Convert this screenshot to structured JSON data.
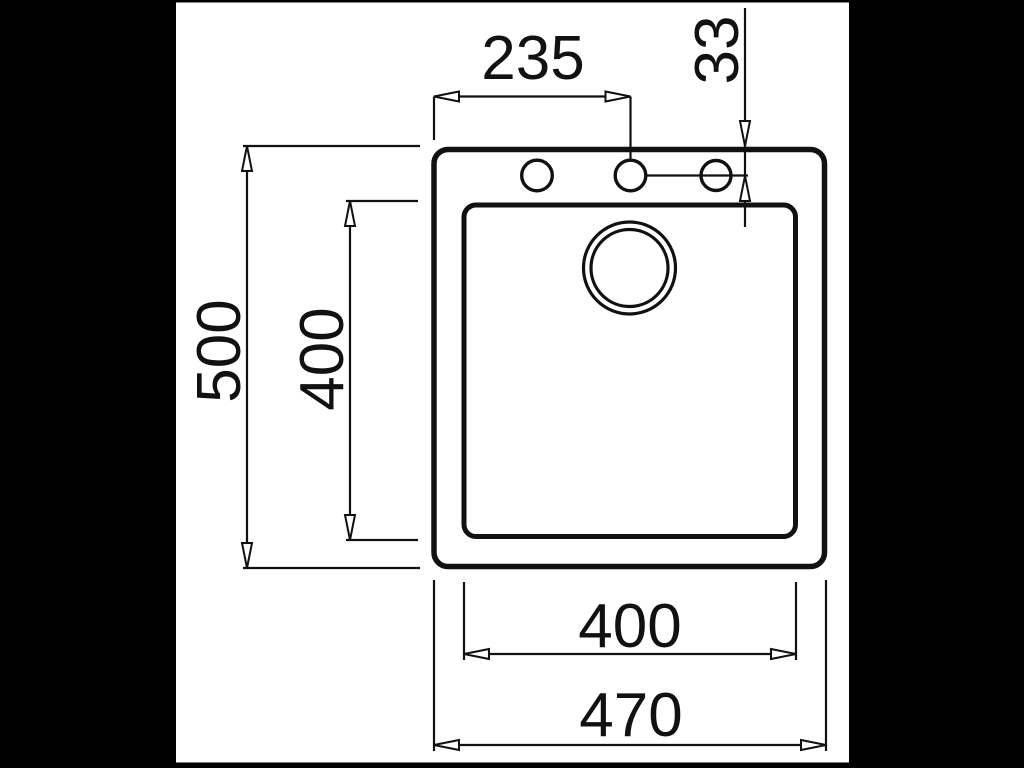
{
  "page": {
    "background_color": "#000000",
    "canvas_color": "#ffffff",
    "line_color": "#111111"
  },
  "drawing": {
    "type": "sink-top-view-technical-drawing",
    "dimensions": [
      {
        "id": "tap-hole-offset-x",
        "value": "235",
        "orientation": "horizontal"
      },
      {
        "id": "tap-hole-offset-y",
        "value": "33",
        "orientation": "vertical"
      },
      {
        "id": "overall-depth",
        "value": "500",
        "orientation": "vertical"
      },
      {
        "id": "bowl-depth",
        "value": "400",
        "orientation": "vertical"
      },
      {
        "id": "bowl-width",
        "value": "400",
        "orientation": "horizontal"
      },
      {
        "id": "overall-width",
        "value": "470",
        "orientation": "horizontal"
      }
    ]
  }
}
